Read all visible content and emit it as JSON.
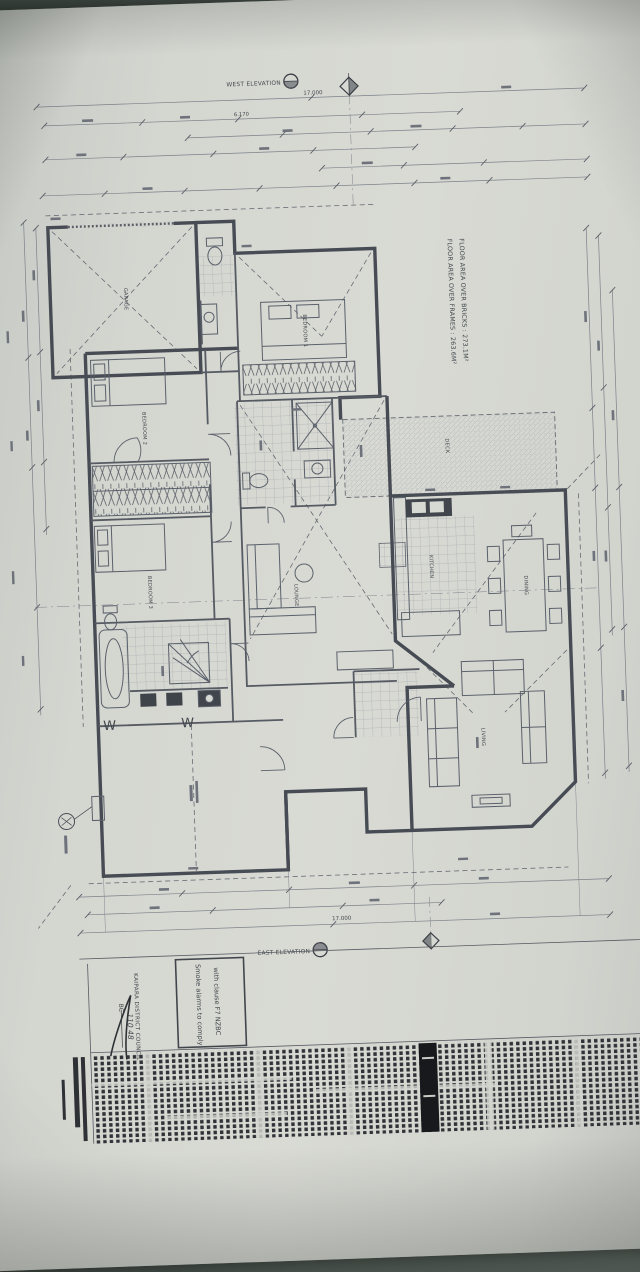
{
  "elevations": {
    "west": "WEST ELEVATION",
    "east": "EAST ELEVATION"
  },
  "floor_area": {
    "line1": "FLOOR AREA OVER FRAMES : 263.6M²",
    "line2": "FLOOR AREA OVER BRICKS : 273.1M²"
  },
  "dimensions": {
    "overall_top": "17.000",
    "segment_top": "6.170",
    "overall_bottom": "17.000"
  },
  "rooms": {
    "garage": "GARAGE",
    "bedroom1": "BEDROOM 1",
    "bedroom2": "BEDROOM 2",
    "bedroom3": "BEDROOM 3",
    "kitchen": "KITCHEN",
    "dining": "DINING",
    "living": "LIVING",
    "lounge": "LOUNGE",
    "deck": "DECK"
  },
  "annotations": {
    "window_mark_left": "W",
    "window_mark_right": "W"
  },
  "stamps": {
    "smoke_alarm": {
      "line1": "Smoke alarms to comply",
      "line2": "with clause F7 NZBC"
    },
    "council": {
      "name": "KAIPARA DISTRICT COUNCIL",
      "field": "BC",
      "number": "110 48"
    }
  }
}
